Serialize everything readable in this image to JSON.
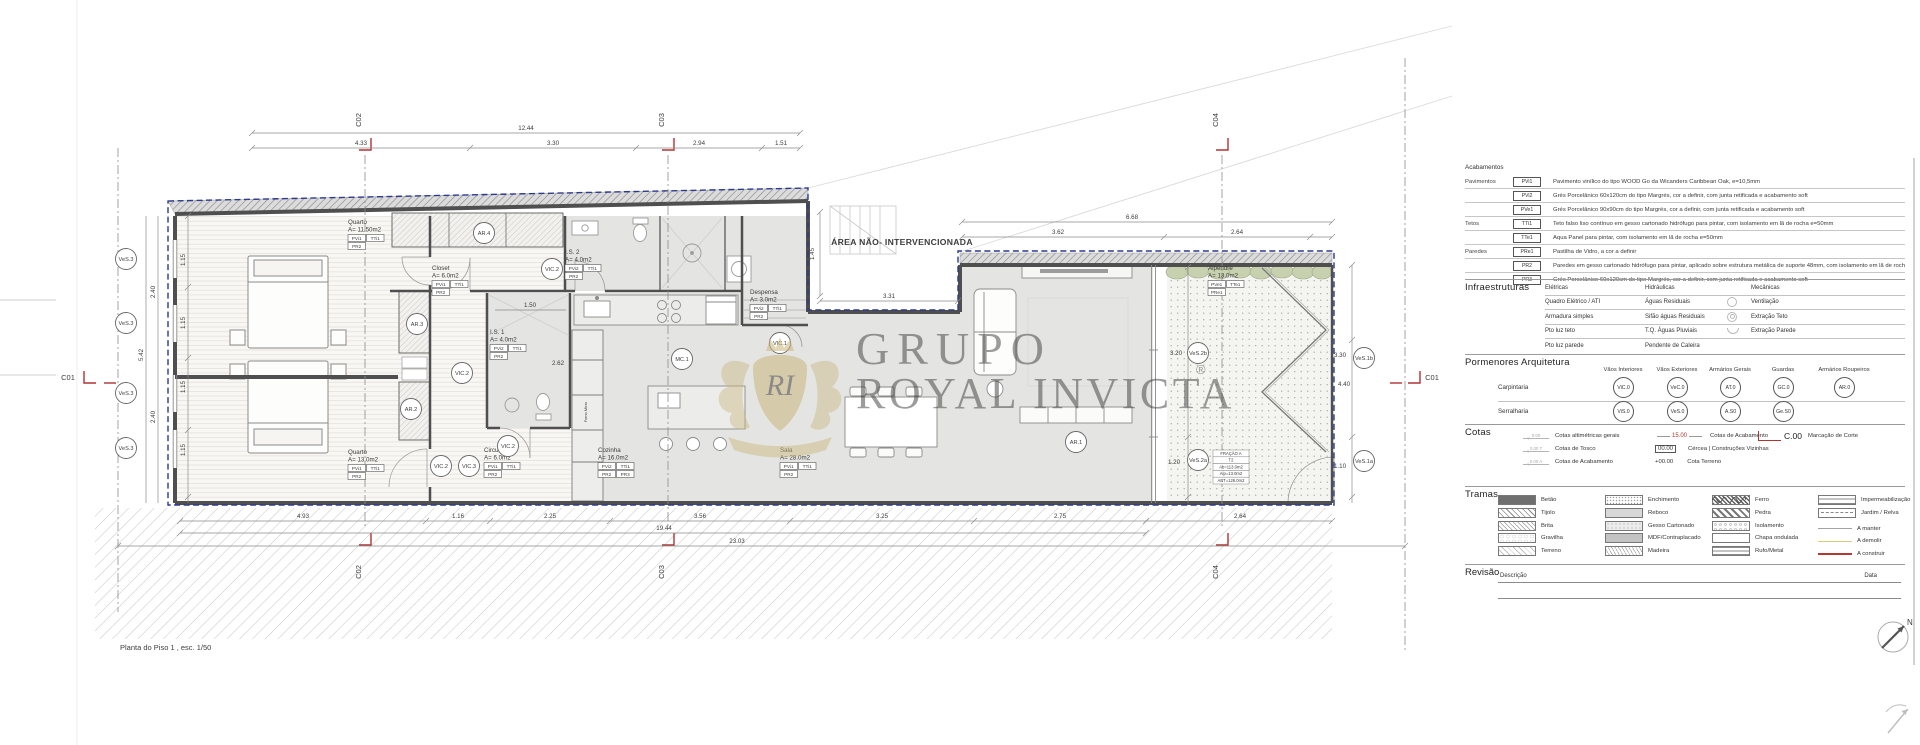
{
  "colors": {
    "boundary_blue": "#2b3a8c",
    "marker_red": "#b03434",
    "watermark_gold": "#c9b77e",
    "a_manter": "#a3a3a3",
    "a_demolir": "#d6cd7a",
    "a_construir": "#b23a32"
  },
  "plan": {
    "caption": "Planta do Piso 1 , esc. 1/50",
    "area_label": "ÁREA NÃO- INTERVENCIONADA",
    "watermark": {
      "word1": "GRUPO",
      "word2": "ROYAL INVICTA",
      "reg": "®",
      "monogram": "RI"
    },
    "fracao": [
      "FRAÇÃO A",
      "T2",
      "Ab=113.0m2",
      "Alp=13.0m2",
      "ABT=126.0m2"
    ],
    "labels": {
      "forno": "Forno Micro"
    },
    "sections": {
      "c01": "C01",
      "c02": "C02",
      "c03": "C03",
      "c04": "C04"
    },
    "rooms": [
      {
        "name": "Quarto",
        "area": "A= 11.50m2",
        "a": "PVi1",
        "b": "TTi1",
        "c": "PR2"
      },
      {
        "name": "Closet",
        "area": "A= 6.0m2",
        "a": "PVi1",
        "b": "TTi1",
        "c": "PR2"
      },
      {
        "name": "I.S. 2",
        "area": "A= 4.0m2",
        "a": "PVi2",
        "b": "TTi1",
        "c": "PR2"
      },
      {
        "name": "I.S. 1",
        "area": "A= 4.0m2",
        "a": "PVi2",
        "b": "TTi1",
        "c": "PR2"
      },
      {
        "name": "Despensa",
        "area": "A= 3.0m2",
        "a": "PVi2",
        "b": "TTi1",
        "c": "PR2"
      },
      {
        "name": "Quarto",
        "area": "A= 13.0m2",
        "a": "PVi1",
        "b": "TTi1",
        "c": "PR2"
      },
      {
        "name": "Circulação",
        "area": "A= 6.0m2",
        "a": "PVi1",
        "b": "TTi1",
        "c": "PR2"
      },
      {
        "name": "Cozinha",
        "area": "A= 16.0m2",
        "a": "PVi2",
        "b": "TTi1",
        "c": "PR2",
        "d": "PR3"
      },
      {
        "name": "Sala",
        "area": "A= 28.0m2",
        "a": "PVi1",
        "b": "TTi1",
        "c": "PR2"
      },
      {
        "name": "Alpendre",
        "area": "A= 13.0m2",
        "a": "PVe1",
        "b": "TTe1",
        "c": "PRe1"
      }
    ],
    "bubbles": [
      "VeS.3",
      "VeS.3",
      "VeS.3",
      "VeS.3",
      "AR.4",
      "VIC.2",
      "AR.3",
      "VIC.2",
      "AR.2",
      "VIC.2",
      "VIC.2",
      "VIC.3",
      "MC.1",
      "VIC.1",
      "AR.1",
      "VeS.2b",
      "VeS.2a",
      "VeS.1b",
      "VeS.1a"
    ],
    "dims": {
      "top_total": "12.44",
      "top": [
        "4.33",
        "3.30",
        "2.94",
        "1.51"
      ],
      "right_total": "6.68",
      "right": [
        "3.62",
        "2.64"
      ],
      "notch_v": "1.45",
      "notch_h": "3.31",
      "left_outer": [
        "2.40",
        "5.42",
        "2.40"
      ],
      "left_inner": "1.15",
      "right_side": [
        "3.30",
        "4.40",
        "1.10"
      ],
      "alp": [
        "3.20",
        "1.20"
      ],
      "is": [
        "1.50",
        "2.62"
      ],
      "bottom": [
        "4.93",
        "1.16",
        "2.25",
        "3.56",
        "3.25",
        "2.75",
        "2.64"
      ],
      "totals": [
        "19.44",
        "23.03"
      ]
    }
  },
  "legend": {
    "acabamentos": {
      "title": "Acabamentos",
      "groups": [
        "Pavimentos",
        "Tetos",
        "Paredes"
      ],
      "rows": [
        {
          "tag": "PVi1",
          "desc": "Pavimento vinílico do tipo WOOD Go da Wicanders Caribbean Oak, e=10,5mm"
        },
        {
          "tag": "PVi2",
          "desc": "Grés Porcelânico 60x120cm do tipo Margrés, cor a definir, com junta retificada e acabamento soft"
        },
        {
          "tag": "PVe1",
          "desc": "Grés Porcelânico 90x90cm do tipo Margrés, cor a definir, com junta retificada e acabamento soft"
        },
        {
          "tag": "TTi1",
          "desc": "Teto falso liso contínuo em gesso cartonado hidrófugo para pintar, com isolamento em lã de rocha e=50mm"
        },
        {
          "tag": "TTe1",
          "desc": "Aqua Panel para pintar, com isolamento em lã de rocha e=50mm"
        },
        {
          "tag": "PRe1",
          "desc": "Pastilha de Vidro, a cor a definir"
        },
        {
          "tag": "PR2",
          "desc": "Paredes em gesso cartonado hidrófugo para pintar, aplicado sobre estrutura metálica de suporte 48mm, com isolamento em lã de rocha 50mm"
        },
        {
          "tag": "PR3",
          "desc": "Grés Porcelânico 60x120cm do tipo Margrés, cor a definir, com junta retificada e acabamento soft"
        }
      ]
    },
    "infraestruturas": {
      "title": "Infraestruturas",
      "cols": [
        "Elétricas",
        "Hidráulicas",
        "Mecânicas"
      ],
      "rows": [
        [
          "Quadro Elétrico / ATI",
          "Águas Residuais",
          "Ventilação"
        ],
        [
          "Armadura simples",
          "Sifão águas Residuais",
          "Extração Teto"
        ],
        [
          "Pto luz teto",
          "T.Q. Águas Pluviais",
          "Extração Parede"
        ],
        [
          "Pto luz parede",
          "Pendente de Caleira",
          ""
        ]
      ]
    },
    "pormenores": {
      "title": "Pormenores Arquitetura",
      "cols": [
        "Vãos Interiores",
        "Vãos Exteriores",
        "Armários Gerais",
        "Guardas",
        "Armários Roupeiros"
      ],
      "carpintaria": {
        "label": "Carpintaria",
        "tags": [
          "ViC.0",
          "VeC.0",
          "AT.0",
          "GC.0",
          "AR.0"
        ]
      },
      "serralharia": {
        "label": "Serralharia",
        "tags": [
          "ViS.0",
          "VeS.0",
          "A.S0",
          "Ge.S0"
        ]
      }
    },
    "cotas": {
      "title": "Cotas",
      "alt": [
        {
          "sym": "0.00",
          "label": "Cotas altimétricas gerais"
        },
        {
          "sym": "0.00 T",
          "label": "Cotas de Tosco"
        },
        {
          "sym": "0.00 A",
          "label": "Cotas de Acabamento"
        }
      ],
      "vals": [
        {
          "value": "15.00",
          "label": "Cotas de Acabamento"
        },
        {
          "value": "00.00",
          "label": "Cércea | Construções Vizinhas"
        },
        {
          "value": "+00.00",
          "label": "Cota Terreno"
        }
      ],
      "corte": {
        "value": "C.00",
        "label": "Marcação de Corte"
      }
    },
    "tramas": {
      "title": "Tramas",
      "col1": [
        "Betão",
        "Tijolo",
        "Brita",
        "Gravilha",
        "Terreno"
      ],
      "col2": [
        "Enchimento",
        "Reboco",
        "Gesso Cartonado",
        "MDF/Contraplacado",
        "Madeira"
      ],
      "col3": [
        "Ferro",
        "Pedra",
        "Isolamento",
        "Chapa ondulada",
        "Rufo/Metal"
      ],
      "col4": [
        "Impermeabilização",
        "Jardim / Relva"
      ],
      "lines": [
        {
          "label": "A manter",
          "color": "#a3a3a3"
        },
        {
          "label": "A demolir",
          "color": "#d6cd7a"
        },
        {
          "label": "A construir",
          "color": "#b23a32"
        }
      ]
    },
    "revisao": {
      "title": "Revisão",
      "desc": "Descrição",
      "data": "Data"
    },
    "north": "N"
  }
}
